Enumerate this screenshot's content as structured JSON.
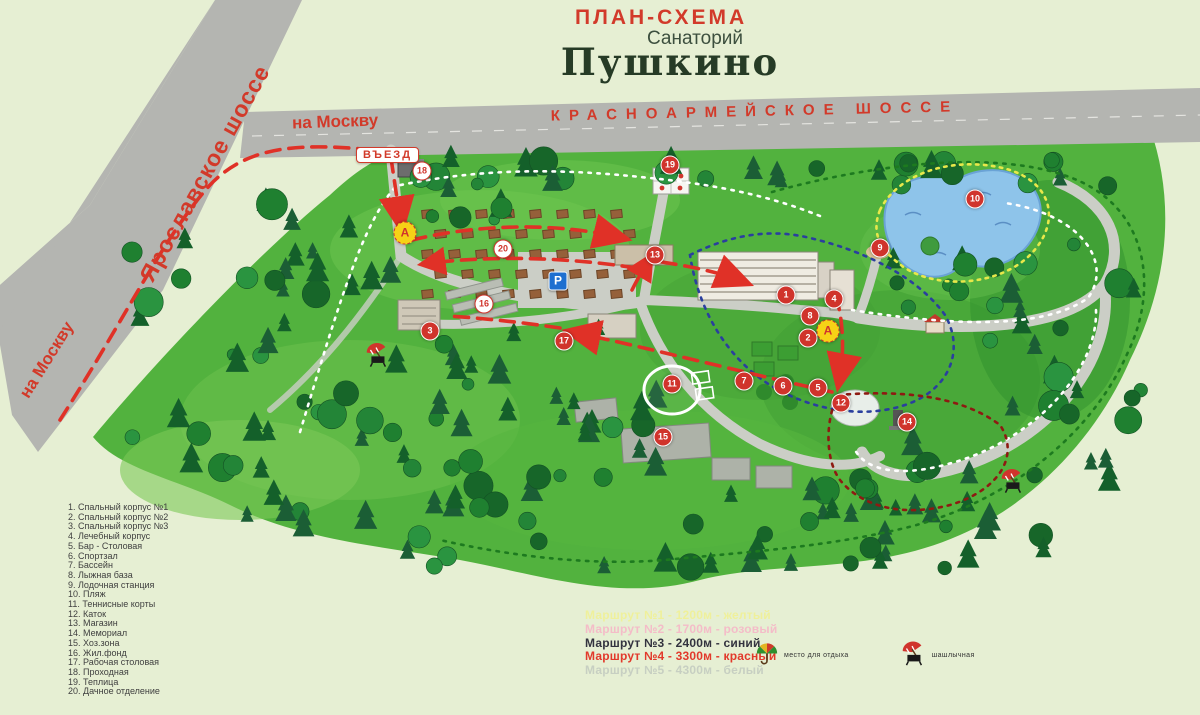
{
  "title": {
    "plan_label": "ПЛАН-СХЕМА",
    "subtitle": "Санаторий",
    "name": "Пушкино"
  },
  "roads": {
    "yaroslavskoe_label": "Ярославское шоссе",
    "krasnoarmeyskoe_label": "КРАСНОАРМЕЙСКОЕ ШОССЕ",
    "to_moscow_top": "на Москву",
    "to_moscow_left": "на Москву",
    "entrance_badge": "ВЪЕЗД"
  },
  "map": {
    "parking_label": "P",
    "bus_stop_label": "А",
    "markers": [
      {
        "n": "1",
        "x": 786,
        "y": 295,
        "style": "red"
      },
      {
        "n": "2",
        "x": 808,
        "y": 338,
        "style": "red"
      },
      {
        "n": "3",
        "x": 430,
        "y": 331,
        "style": "red"
      },
      {
        "n": "4",
        "x": 834,
        "y": 299,
        "style": "red"
      },
      {
        "n": "5",
        "x": 818,
        "y": 388,
        "style": "red"
      },
      {
        "n": "6",
        "x": 783,
        "y": 386,
        "style": "red"
      },
      {
        "n": "7",
        "x": 744,
        "y": 381,
        "style": "red"
      },
      {
        "n": "8",
        "x": 810,
        "y": 316,
        "style": "red"
      },
      {
        "n": "9",
        "x": 880,
        "y": 248,
        "style": "red"
      },
      {
        "n": "10",
        "x": 975,
        "y": 199,
        "style": "red"
      },
      {
        "n": "11",
        "x": 672,
        "y": 384,
        "style": "red"
      },
      {
        "n": "12",
        "x": 841,
        "y": 403,
        "style": "red"
      },
      {
        "n": "13",
        "x": 655,
        "y": 255,
        "style": "red"
      },
      {
        "n": "14",
        "x": 907,
        "y": 422,
        "style": "red"
      },
      {
        "n": "15",
        "x": 663,
        "y": 437,
        "style": "red"
      },
      {
        "n": "16",
        "x": 484,
        "y": 304,
        "style": "white"
      },
      {
        "n": "17",
        "x": 564,
        "y": 341,
        "style": "red"
      },
      {
        "n": "18",
        "x": 422,
        "y": 171,
        "style": "white"
      },
      {
        "n": "19",
        "x": 670,
        "y": 165,
        "style": "red"
      },
      {
        "n": "20",
        "x": 503,
        "y": 249,
        "style": "white"
      }
    ],
    "bus_stops": [
      {
        "x": 405,
        "y": 233
      },
      {
        "x": 828,
        "y": 331
      }
    ],
    "map_icons": [
      {
        "icon": "bbq",
        "x": 377,
        "y": 357
      },
      {
        "icon": "bbq",
        "x": 1012,
        "y": 483
      }
    ]
  },
  "legend": {
    "items": [
      "1. Спальный корпус №1",
      "2. Спальный корпус №2",
      "3. Спальный корпус №3",
      "4. Лечебный корпус",
      "5. Бар - Столовая",
      "6. Спортзал",
      "7. Бассейн",
      "8. Лыжная база",
      "9. Лодочная станция",
      "10. Пляж",
      "11. Теннисные корты",
      "12. Каток",
      "13. Магазин",
      "14. Мемориал",
      "15. Хоз.зона",
      "16. Жил.фонд",
      "17. Рабочая столовая",
      "18. Проходная",
      "19. Теплица",
      "20. Дачное отделение"
    ]
  },
  "routes": {
    "items": [
      {
        "text": "Маршрут №1 - 1200м - желтый",
        "color": "#eff09b"
      },
      {
        "text": "Маршрут №2 - 1700м - розовый",
        "color": "#f4bcc8"
      },
      {
        "text": "Маршрут №3 - 2400м - синий",
        "color": "#33333f"
      },
      {
        "text": "Маршрут №4 - 3300м - красный",
        "color": "#e2392b"
      },
      {
        "text": "Маршрут №5 - 4300м - белый",
        "color": "#c7cfc2"
      }
    ]
  },
  "poi_legend": [
    {
      "icon": "rest-area",
      "label": "место для отдыха"
    },
    {
      "icon": "bbq",
      "label": "шашлычная"
    }
  ],
  "colors": {
    "accent_red": "#d0342c",
    "road_gray": "#b4b5b1",
    "map_green": "#52b23e",
    "lake_blue": "#8ec4ea",
    "route_red": "#e03127",
    "route_blue": "#2a3f9e",
    "route_green": "#1d7a1f",
    "route_white": "#ffffff",
    "route_darkred": "#8e1a12",
    "route_yellow": "#e8e84a"
  }
}
